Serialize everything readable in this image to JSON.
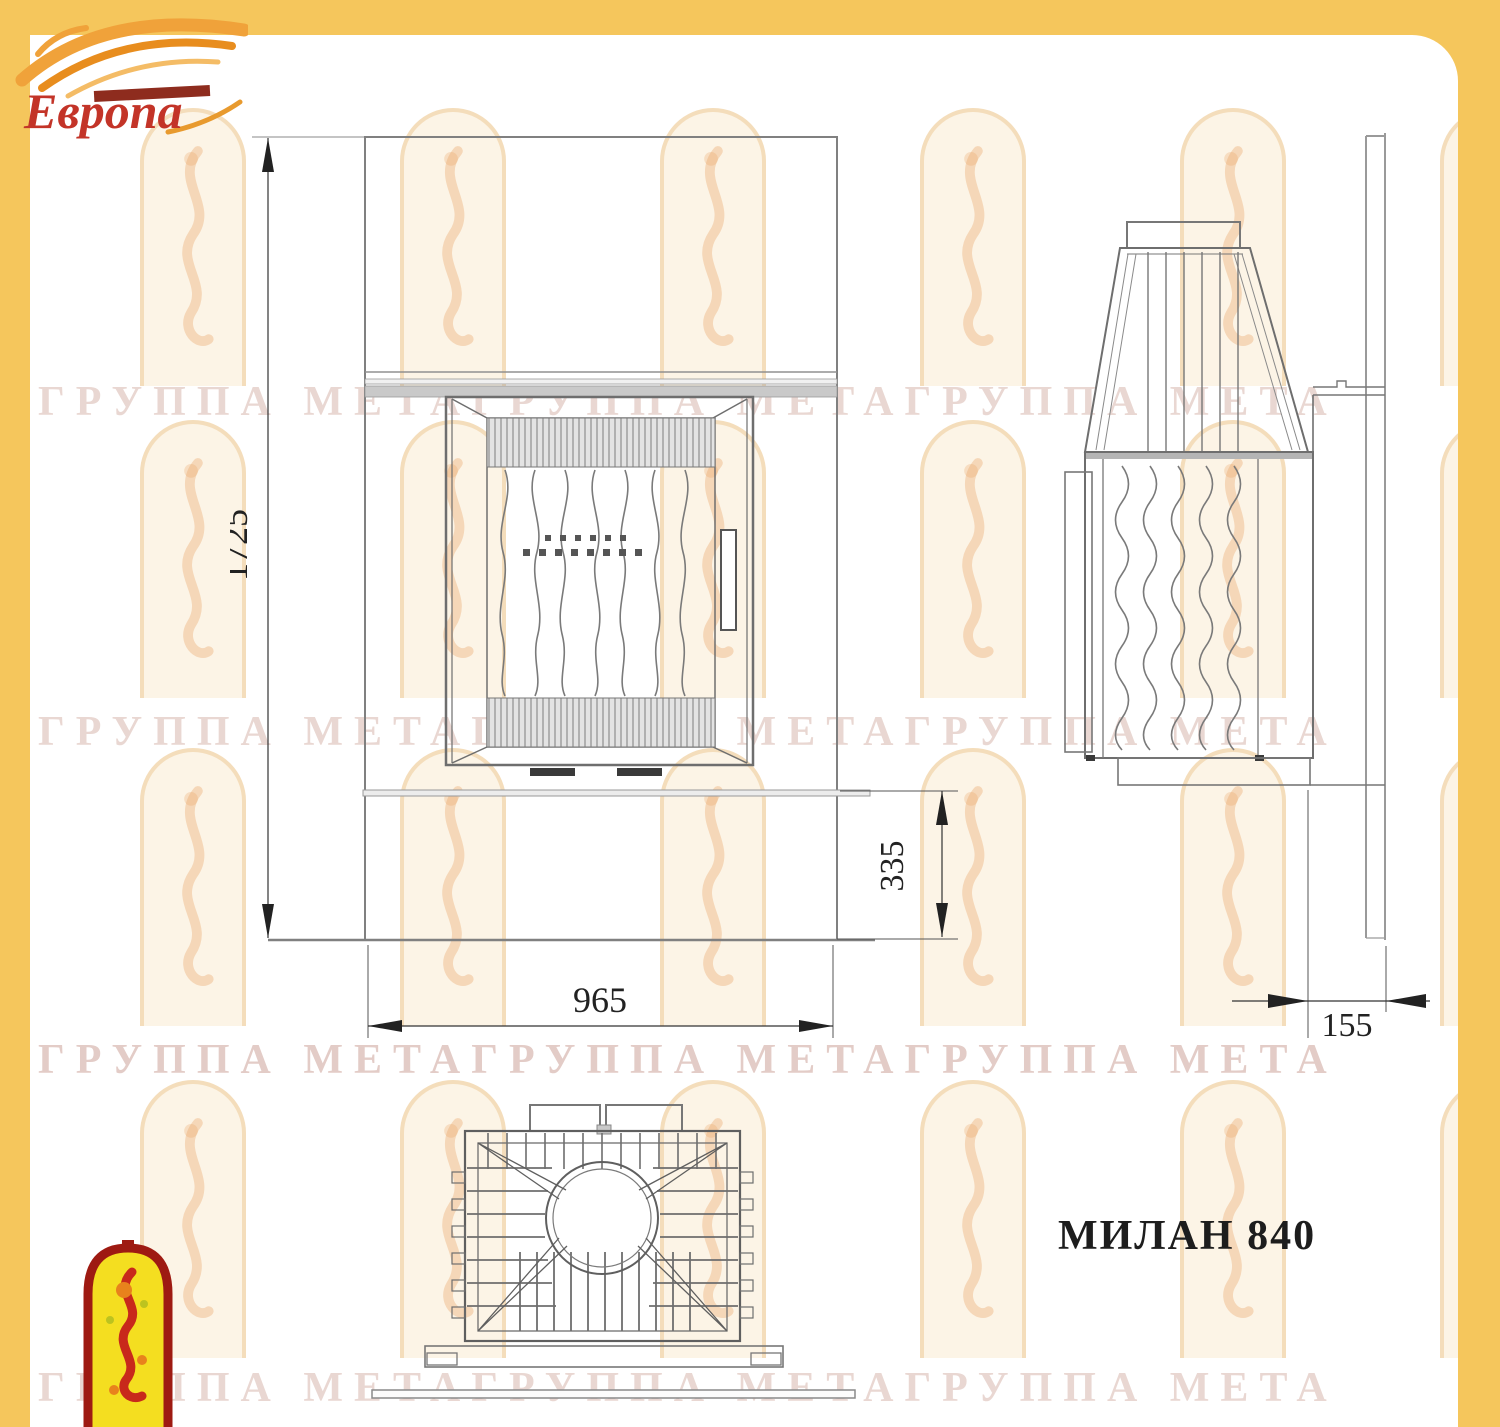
{
  "frame": {
    "border_color": "#F5C65C"
  },
  "logo": {
    "wordmark": "Европа"
  },
  "watermark": {
    "row_text": "ГРУППА МЕТАГРУППА МЕТАГРУППА МЕТА"
  },
  "drawing": {
    "title": "МИЛАН 840",
    "dimensions": {
      "overall_height": "1725",
      "plinth_height": "335",
      "overall_width": "965",
      "depth_gap": "155"
    }
  }
}
